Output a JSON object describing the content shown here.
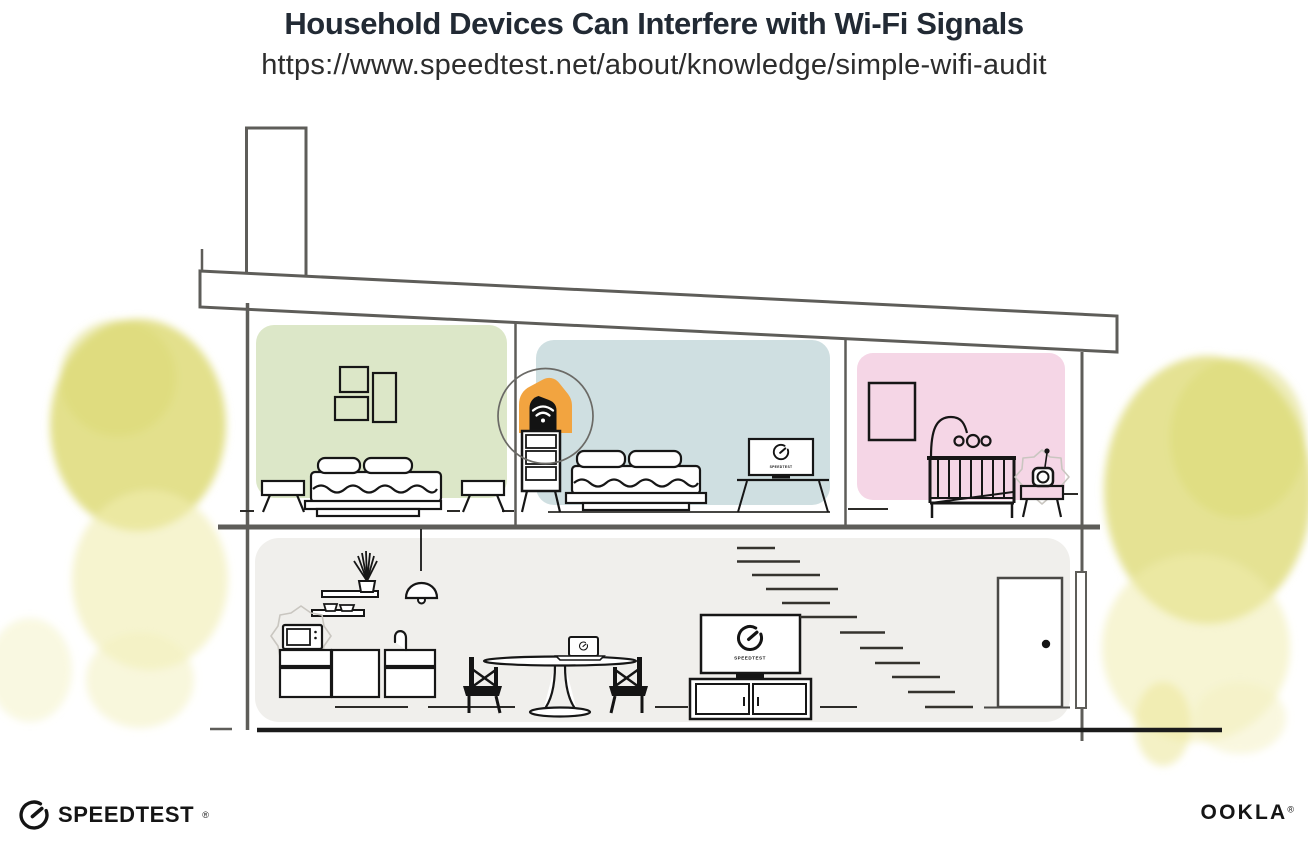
{
  "header": {
    "title": "Household Devices Can Interfere with Wi-Fi Signals",
    "url": "https://www.speedtest.net/about/knowledge/simple-wifi-audit"
  },
  "branding": {
    "speedtest": {
      "label": "SPEEDTEST",
      "trademark": "®"
    },
    "ookla": {
      "label": "OOKLA",
      "trademark": "®"
    }
  },
  "illustration": {
    "description": "Cross-section of a two-story house showing household devices that can interfere with Wi-Fi signals",
    "colors": {
      "structure_line": "#5e5d59",
      "furniture_line": "#161616",
      "ground_line": "#1b1b1b",
      "router_highlight": "#f2a440",
      "highlight_circle": "#6b6a66",
      "interference_outline": "#c9c6c0",
      "tree_dark": "#dcd973",
      "tree_main": "#e0dd80",
      "tree_light": "#f0edaf"
    },
    "rooms": [
      {
        "id": "bedroom-left",
        "label": "bedroom (green)",
        "wall_color": "#dce7c8"
      },
      {
        "id": "bedroom-middle",
        "label": "bedroom (blue)",
        "wall_color": "#cfdfe1"
      },
      {
        "id": "nursery",
        "label": "nursery (pink)",
        "wall_color": "#f5d6e6"
      },
      {
        "id": "main-floor",
        "label": "kitchen and living room",
        "wall_color": "#f0efec"
      }
    ],
    "devices": [
      {
        "id": "wifi-router",
        "label": "Wi-Fi router",
        "location": "dresser in middle bedroom",
        "highlighted": true
      },
      {
        "id": "tv-bedroom",
        "label": "TV running Speedtest",
        "location": "middle bedroom"
      },
      {
        "id": "baby-monitor",
        "label": "baby monitor",
        "location": "nursery",
        "interference": true
      },
      {
        "id": "microwave",
        "label": "microwave oven",
        "location": "kitchen",
        "interference": true
      },
      {
        "id": "laptop-dining",
        "label": "laptop running Speedtest",
        "location": "dining table"
      },
      {
        "id": "tv-living",
        "label": "TV running Speedtest",
        "location": "living room"
      }
    ],
    "screen_labels": {
      "tv_bedroom": "SPEEDTEST",
      "tv_living": "SPEEDTEST"
    }
  }
}
